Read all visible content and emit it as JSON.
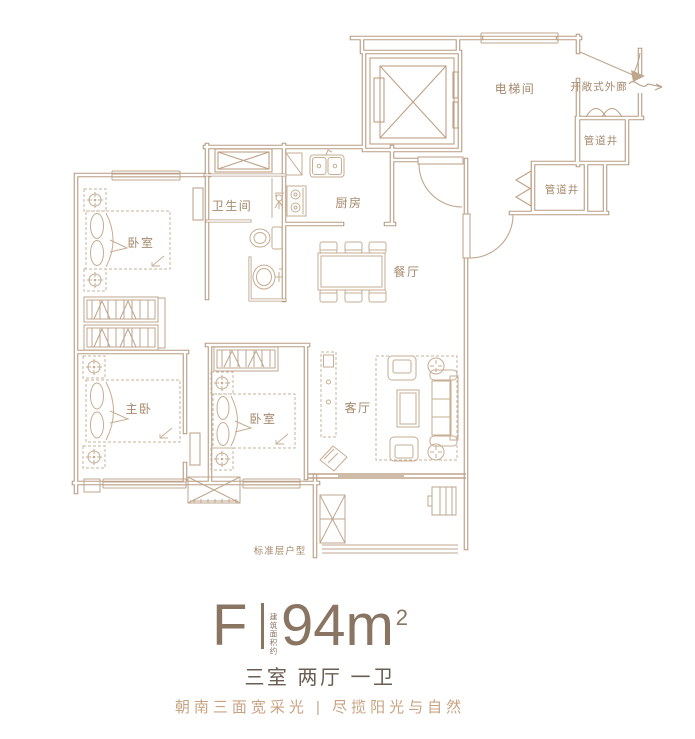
{
  "floor_plan": {
    "caption": "标准层户型",
    "rooms": {
      "bedroom_top": "卧室",
      "bathroom": "卫生间",
      "kitchen": "厨房",
      "dining": "餐厅",
      "elevator_hall": "电梯间",
      "open_corridor": "开敞式外廊",
      "pipe_shaft_upper": "管道井",
      "pipe_shaft_lower": "管道井",
      "master_bedroom": "主卧",
      "bedroom_bottom": "卧室",
      "living_room": "客厅"
    }
  },
  "summary": {
    "unit_code": "F",
    "area_prefix": "建筑面积约",
    "area_value": "94m",
    "area_superscript": "2",
    "layout_text": "三室 两厅 一卫",
    "tagline": "朝南三面宽采光 | 尽揽阳光与自然"
  },
  "colors": {
    "wall_line": "#b89c82",
    "furniture_line": "#c6ad93",
    "room_label": "#a5896b",
    "title_text": "#8a7462",
    "subtitle_text": "#6a5d52",
    "tagline_text": "#c8a382"
  }
}
